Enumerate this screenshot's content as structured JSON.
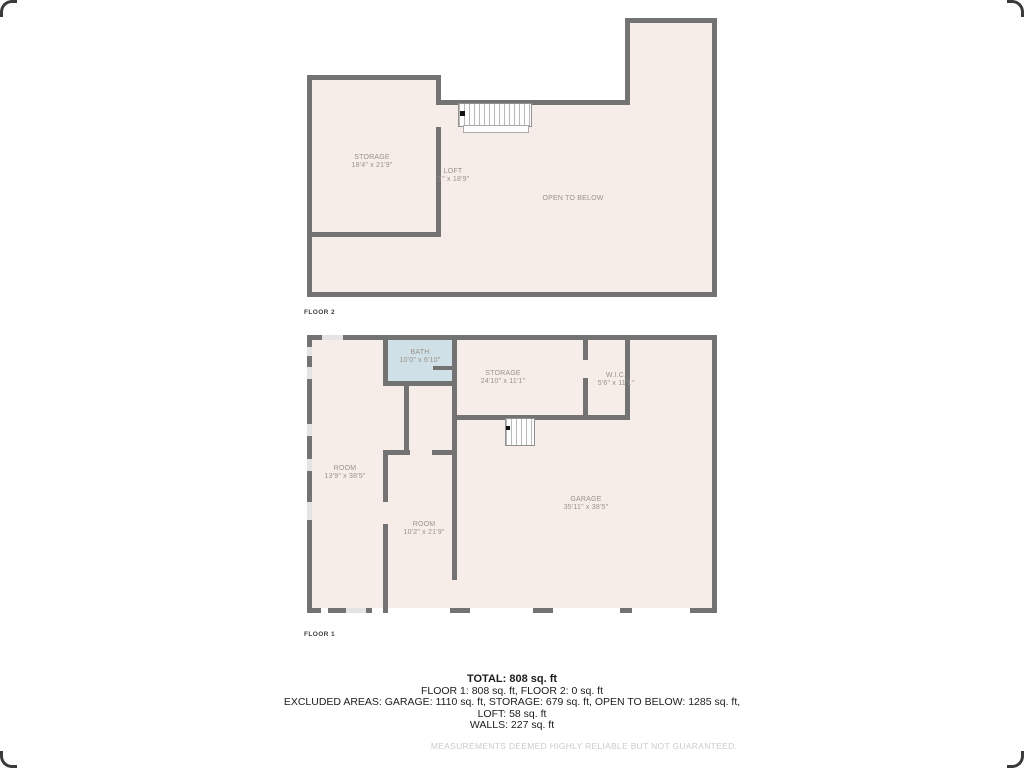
{
  "colors": {
    "background": "#ffffff",
    "wall": "#737373",
    "floor_fill": "#f6ece8",
    "bath_fill": "#cfe0e6",
    "window_marker": "#e4e4e4",
    "room_label_text": "#9a918d",
    "summary_text": "#1c1c1c",
    "disclaimer_text": "#cbcbcb"
  },
  "floor2": {
    "label": "FLOOR 2",
    "rooms": [
      {
        "name": "STORAGE",
        "dims": "18'4\" x 21'9\""
      },
      {
        "name": "LOFT",
        "dims": "'1\" x 18'9\""
      },
      {
        "name": "OPEN TO BELOW",
        "dims": ""
      }
    ]
  },
  "floor1": {
    "label": "FLOOR 1",
    "rooms": [
      {
        "name": "BATH",
        "dims": "10'0\" x 6'10\""
      },
      {
        "name": "STORAGE",
        "dims": "24'10\" x 11'1\""
      },
      {
        "name": "W.I.C.",
        "dims": "5'6\" x 11'1\""
      },
      {
        "name": "ROOM",
        "dims": "13'9\" x 38'5\""
      },
      {
        "name": "ROOM",
        "dims": "10'2\" x 21'9\""
      },
      {
        "name": "GARAGE",
        "dims": "35'11\" x 38'5\""
      }
    ]
  },
  "summary": {
    "total": "TOTAL: 808 sq. ft",
    "floors": "FLOOR 1: 808 sq. ft, FLOOR 2: 0 sq. ft",
    "excluded": "EXCLUDED AREAS: GARAGE: 1110 sq. ft, STORAGE: 679 sq. ft, OPEN TO BELOW: 1285 sq. ft,",
    "loft": "LOFT: 58 sq. ft",
    "walls": "WALLS: 227 sq. ft",
    "disclaimer": "MEASUREMENTS DEEMED HIGHLY RELIABLE BUT NOT GUARANTEED."
  }
}
